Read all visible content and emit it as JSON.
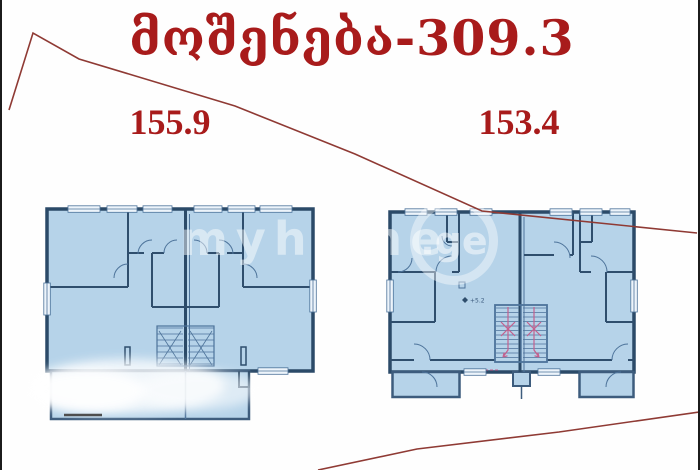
{
  "header": {
    "title": "მოშენება-309.3"
  },
  "plans": {
    "left": {
      "area_label": "155.9"
    },
    "right": {
      "area_label": "153.4",
      "elevation_label": "+5.2"
    }
  },
  "watermark": {
    "text_main": "myhome",
    "text_suffix": ".ge"
  },
  "colors": {
    "accent_red": "#a81b1b",
    "boundary_line_red": "#8f3a34",
    "plan_fill": "#b6d3e9",
    "plan_wall_dark": "#2b4a68",
    "plan_line_thin": "#4d739a",
    "stair_arrow_pink": "#c4608e"
  }
}
